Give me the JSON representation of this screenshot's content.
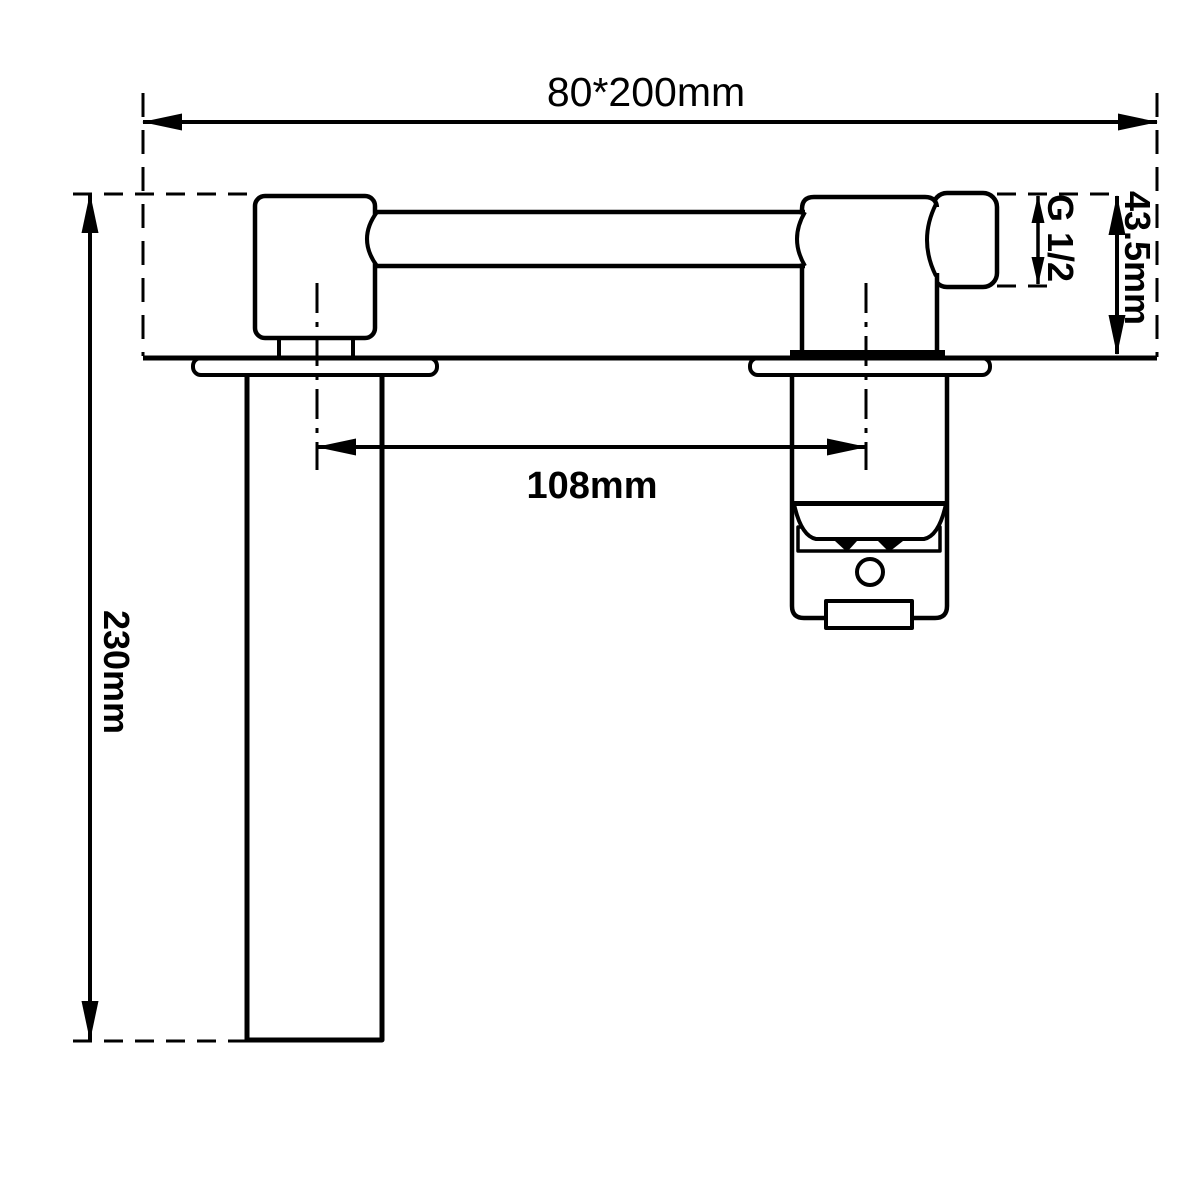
{
  "page": {
    "type": "technical-dimension-drawing",
    "subject": "wall-mounted basin faucet, front elevation with installation dimensions",
    "background_color": "#ffffff",
    "line_color": "#000000"
  },
  "dimensions": [
    {
      "name": "overall-size",
      "value": "80*200mm",
      "orientation": "horizontal"
    },
    {
      "name": "thread-size",
      "value": "G 1/2",
      "orientation": "vertical"
    },
    {
      "name": "body-height",
      "value": "43.5mm",
      "orientation": "vertical"
    },
    {
      "name": "spout-valve-center-distance",
      "value": "108mm",
      "orientation": "horizontal"
    },
    {
      "name": "inlet-pipe-length",
      "value": "230mm",
      "orientation": "vertical"
    }
  ]
}
